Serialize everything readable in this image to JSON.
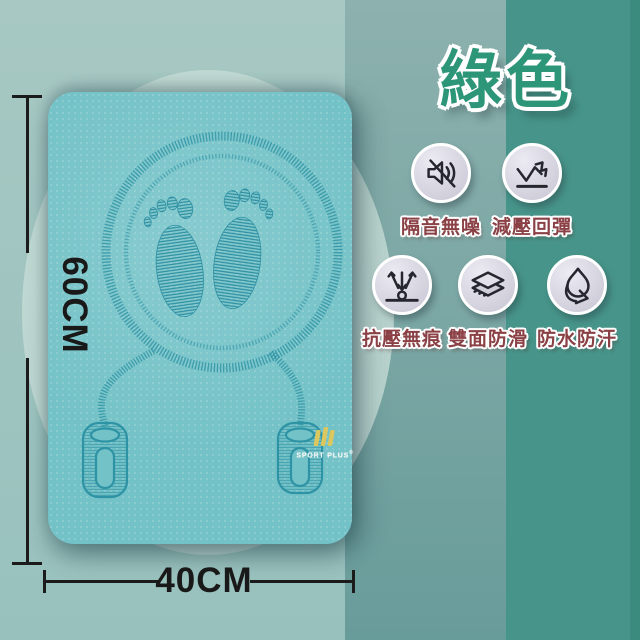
{
  "title": {
    "text": "綠色",
    "color": "#2d9678"
  },
  "features": [
    {
      "label": "隔音無噪",
      "icon": "muted-speaker-icon"
    },
    {
      "label": "減壓回彈",
      "icon": "rebound-arrow-icon"
    },
    {
      "label": "抗壓無痕",
      "icon": "pressure-resist-icon"
    },
    {
      "label": "雙面防滑",
      "icon": "double-layer-icon"
    },
    {
      "label": "防水防汗",
      "icon": "waterproof-drop-icon"
    }
  ],
  "dimensions": {
    "height_label": "60CM",
    "width_label": "40CM"
  },
  "brand": {
    "name": "SPORT PLUS",
    "reg": "®"
  },
  "colors": {
    "accent_green": "#2d9678",
    "label_maroon": "#8a4044",
    "mat_teal": "#73c2c7",
    "engraving_teal": "#2e93a4",
    "band_left": "#9dc2be",
    "band_middle": "#7aa5a2",
    "band_right": "#47958a",
    "badge_fill": "#d6d5e0"
  }
}
